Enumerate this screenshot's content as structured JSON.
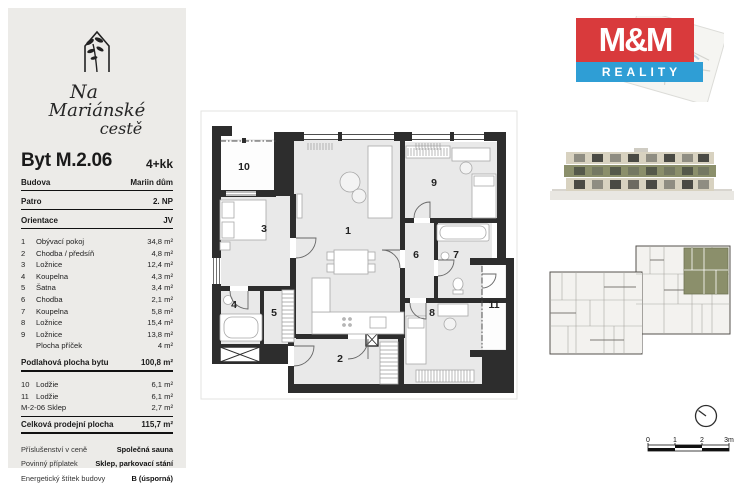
{
  "sidebar": {
    "project_name": {
      "line1": "Na",
      "line2": "Mariánské",
      "line3": "cestě"
    },
    "unit_title": "Byt M.2.06",
    "unit_layout": "4+kk",
    "info_rows": [
      {
        "label": "Budova",
        "value": "Mariin dům"
      },
      {
        "label": "Patro",
        "value": "2. NP"
      },
      {
        "label": "Orientace",
        "value": "JV"
      }
    ],
    "room_rows": [
      {
        "num": "1",
        "name": "Obývací pokoj",
        "area": "34,8 m²"
      },
      {
        "num": "2",
        "name": "Chodba / předsíň",
        "area": "4,8 m²"
      },
      {
        "num": "3",
        "name": "Ložnice",
        "area": "12,4 m²"
      },
      {
        "num": "4",
        "name": "Koupelna",
        "area": "4,3 m²"
      },
      {
        "num": "5",
        "name": "Šatna",
        "area": "3,4 m²"
      },
      {
        "num": "6",
        "name": "Chodba",
        "area": "2,1 m²"
      },
      {
        "num": "7",
        "name": "Koupelna",
        "area": "5,8 m²"
      },
      {
        "num": "8",
        "name": "Ložnice",
        "area": "15,4 m²"
      },
      {
        "num": "9",
        "name": "Ložnice",
        "area": "13,8 m²"
      }
    ],
    "partition_row": {
      "name": "Plocha příček",
      "area": "4 m²"
    },
    "floor_area_row": {
      "label": "Podlahová plocha bytu",
      "value": "100,8 m²"
    },
    "extra_rows": [
      {
        "num": "10",
        "name": "Lodžie",
        "area": "6,1 m²"
      },
      {
        "num": "11",
        "name": "Lodžie",
        "area": "6,1 m²"
      }
    ],
    "cellar_row": {
      "name": "M-2-06 Sklep",
      "area": "2,7 m²"
    },
    "total_row": {
      "label": "Celková prodejní plocha",
      "value": "115,7 m²"
    },
    "detail_rows": [
      {
        "label": "Příslušenství v ceně",
        "value": "Společná sauna"
      },
      {
        "label": "Povinný příplatek",
        "value": "Sklep, parkovací stání"
      },
      {
        "label": "Energetický štítek budovy",
        "value": "B (úsporná)"
      }
    ]
  },
  "plan": {
    "room_labels": [
      "1",
      "2",
      "3",
      "4",
      "5",
      "6",
      "7",
      "8",
      "9",
      "10",
      "11"
    ]
  },
  "brand": {
    "name": "M&M",
    "tagline": "REALITY",
    "red": "#d93a3c",
    "blue": "#2f9ed5"
  },
  "scalebar": {
    "ticks": [
      "0",
      "1",
      "2",
      "3m"
    ]
  },
  "colors": {
    "sidebar_bg": "#ecebe8",
    "wall": "#2d2d2d",
    "room_fill": "#e9e9e9",
    "highlight_olive": "#8b8f6b"
  }
}
